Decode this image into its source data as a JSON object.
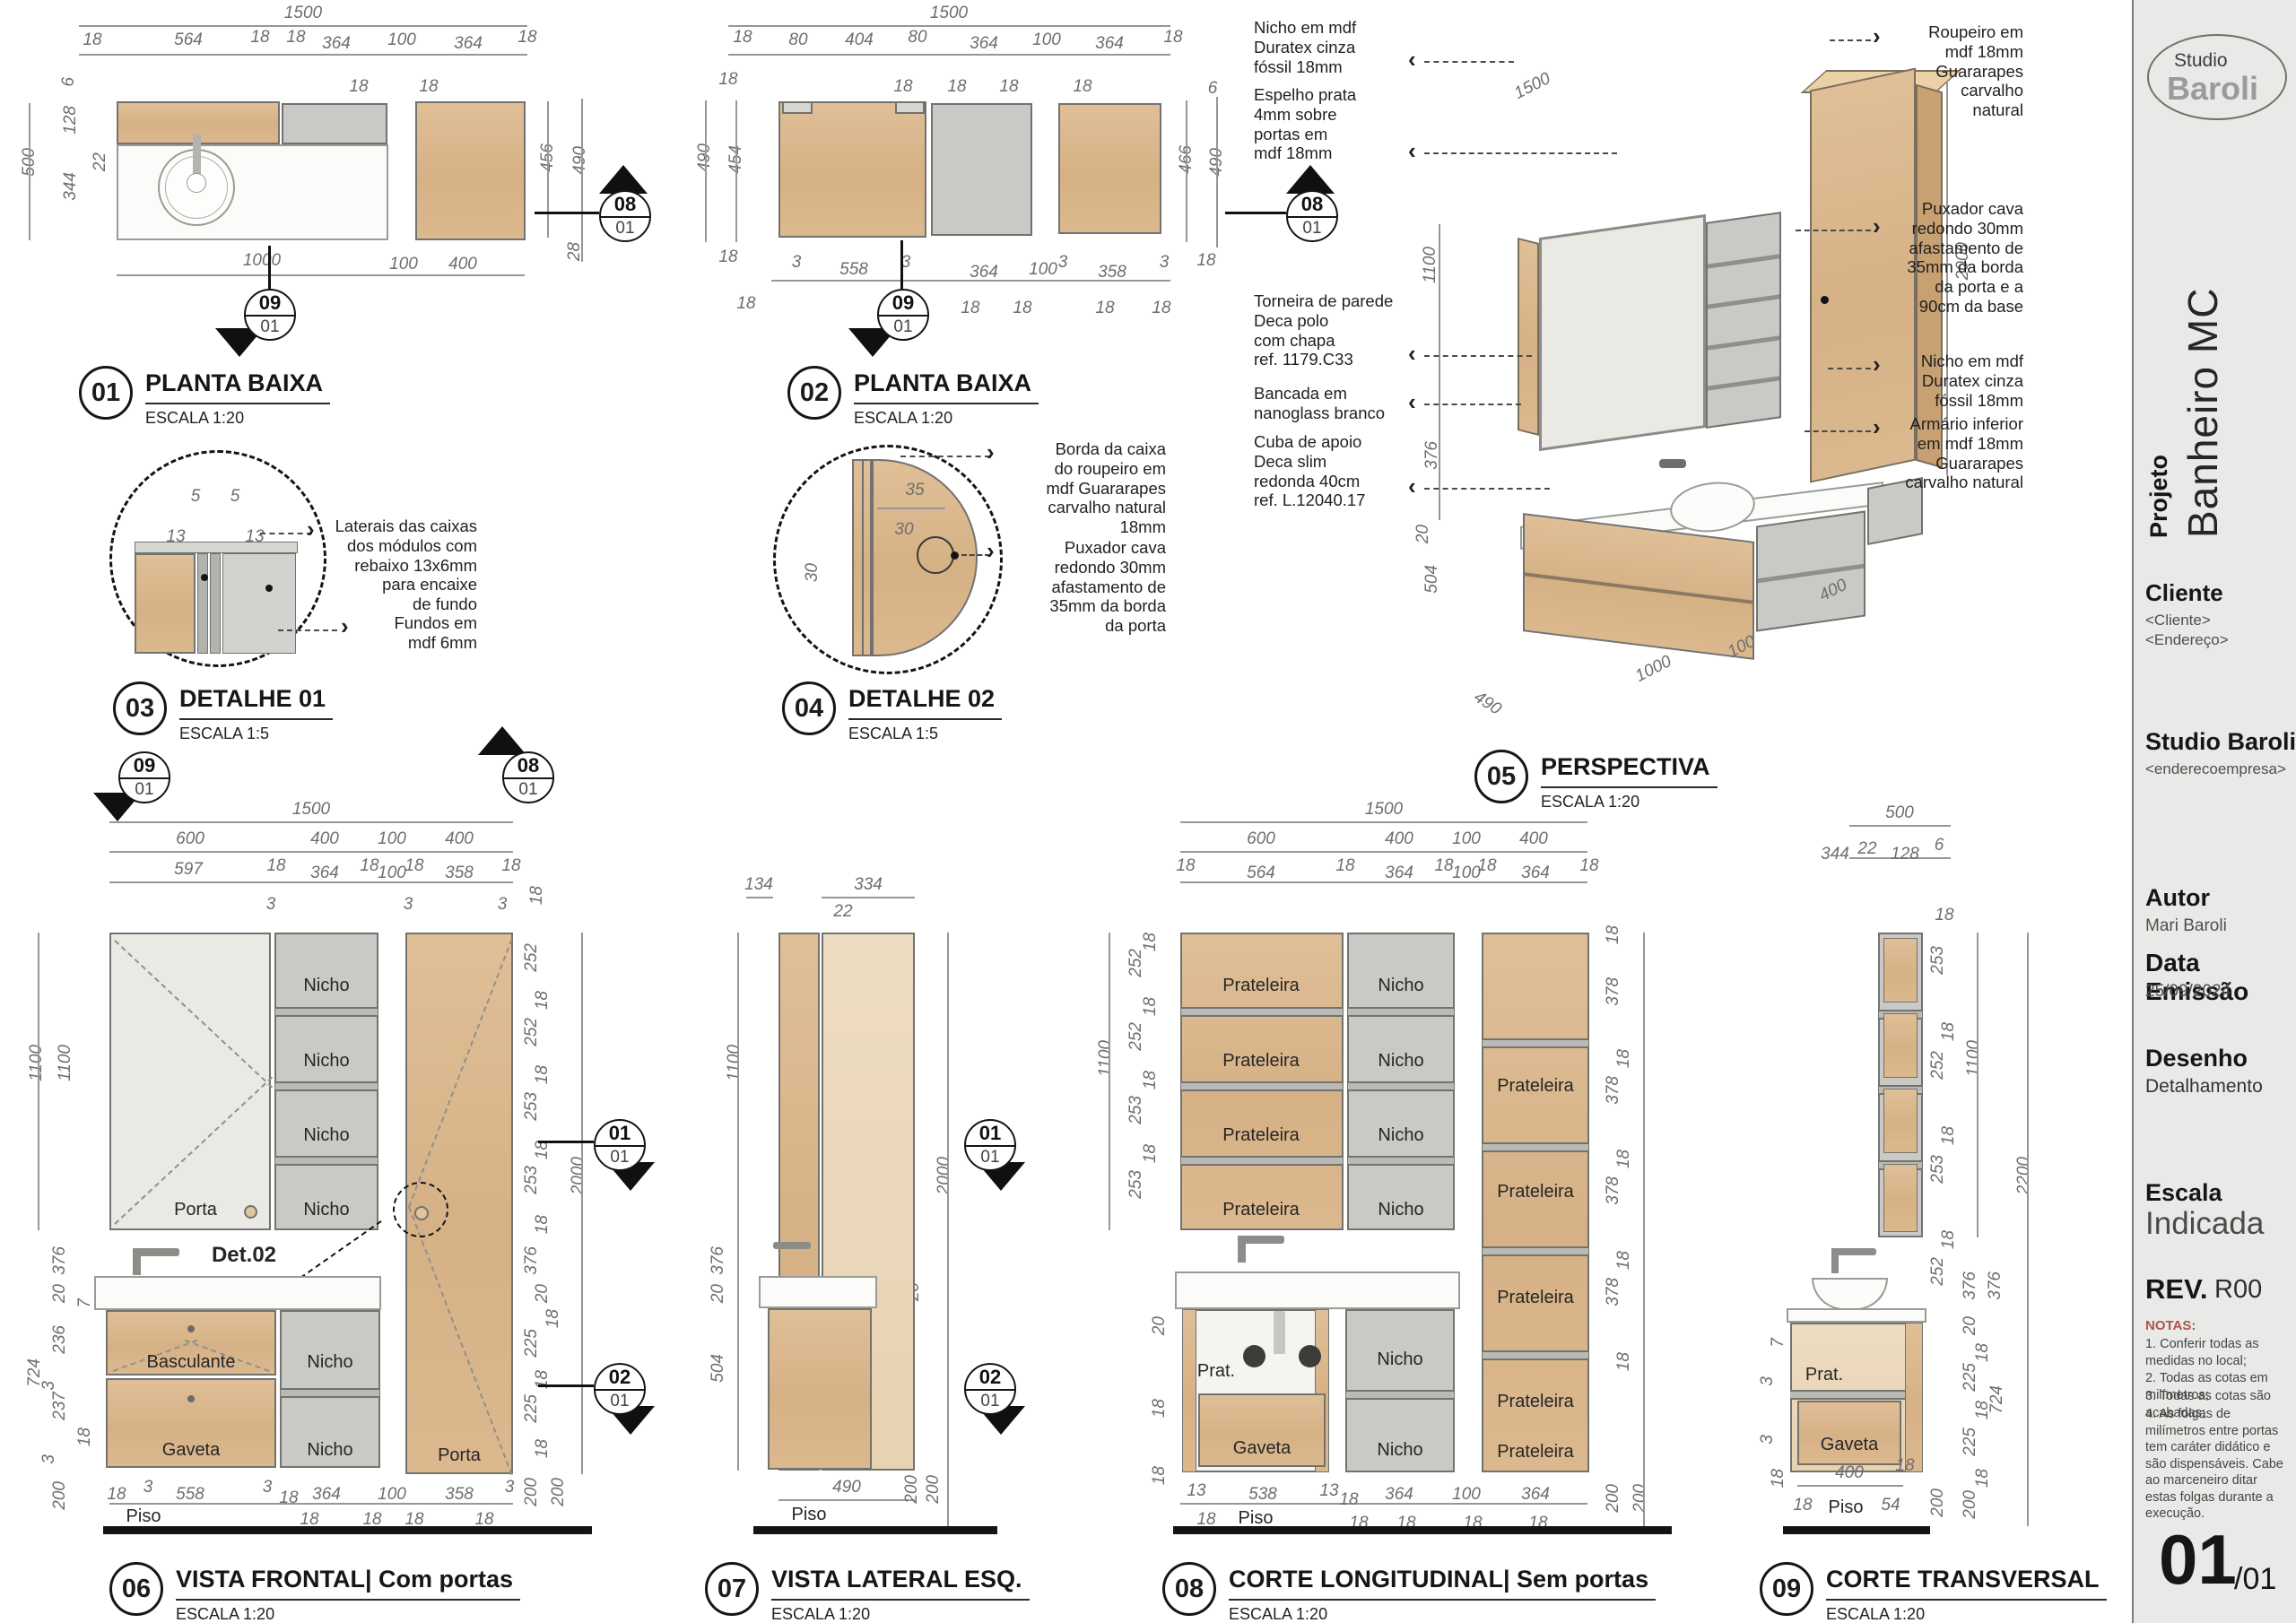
{
  "colors": {
    "wood": "#d8b68c",
    "wood_light": "#ead8bd",
    "panel_gray": "#c8c8c4",
    "mirror": "#ebe9e4",
    "ink": "#1c1c1c",
    "dim_gray": "#6e6e6e",
    "notes_red": "#b0534c",
    "titleblock_bg": "#e9e9e7"
  },
  "labels": {
    "nicho": "Nicho",
    "prateleira": "Prateleira",
    "porta": "Porta",
    "gaveta": "Gaveta",
    "basculante": "Basculante",
    "prat": "Prat.",
    "piso": "Piso",
    "det02": "Det.02"
  },
  "markers": {
    "m08": {
      "a": "08",
      "b": "01"
    },
    "m09": {
      "a": "09",
      "b": "01"
    },
    "m01": {
      "a": "01",
      "b": "01"
    },
    "m02": {
      "a": "02",
      "b": "01"
    }
  },
  "titleblock": {
    "logo_top": "Studio",
    "logo_main": "Baroli",
    "project_label": "Projeto",
    "project_name": "Banheiro MC",
    "cliente_label": "Cliente",
    "cliente_value": "<Cliente>",
    "cliente_endereco": "<Endereço>",
    "studio_name": "Studio Baroli",
    "studio_endereco": "<enderecoempresa>",
    "autor_label": "Autor",
    "autor_value": "Mari Baroli",
    "data_label": "Data Emissão",
    "data_value": "25/09/2024",
    "desenho_label": "Desenho",
    "desenho_value": "Detalhamento",
    "escala_label": "Escala",
    "escala_value": "Indicada",
    "rev_label": "REV.",
    "rev_value": "R00",
    "notas_title": "NOTAS:",
    "notas": [
      "1. Conferir todas as medidas no local;",
      "2. Todas as cotas em milímetros;",
      "3. Todas as cotas são acabadas;",
      "4. As folgas de milímetros entre portas tem caráter didático e são dispensáveis. Cabe ao marceneiro ditar estas folgas durante a execução."
    ],
    "page_num": "01",
    "page_total": "/01"
  },
  "views": {
    "v01": {
      "num": "01",
      "title": "PLANTA BAIXA",
      "scale": "ESCALA 1:20",
      "dims": [
        "1500",
        "18",
        "564",
        "18",
        "18",
        "364",
        "100",
        "364",
        "18",
        "18",
        "18",
        "6",
        "128",
        "22",
        "344",
        "500",
        "1000",
        "100",
        "400",
        "456",
        "490",
        "28"
      ]
    },
    "v02": {
      "num": "02",
      "title": "PLANTA BAIXA",
      "scale": "ESCALA 1:20",
      "dims": [
        "1500",
        "18",
        "80",
        "404",
        "80",
        "364",
        "100",
        "364",
        "18",
        "18",
        "18",
        "18",
        "18",
        "490",
        "454",
        "18",
        "18",
        "6",
        "466",
        "490",
        "18",
        "3",
        "558",
        "3",
        "364",
        "100",
        "3",
        "358",
        "3",
        "18",
        "18",
        "18",
        "18",
        "18",
        "18"
      ]
    },
    "v03": {
      "num": "03",
      "title": "DETALHE 01",
      "scale": "ESCALA 1:5",
      "dims": [
        "5",
        "5",
        "13",
        "13"
      ],
      "ann1": "Laterais das caixas\ndos módulos com\nrebaixo 13x6mm\npara encaixe\nde fundo",
      "ann2": "Fundos em\nmdf 6mm"
    },
    "v04": {
      "num": "04",
      "title": "DETALHE 02",
      "scale": "ESCALA 1:5",
      "dims": [
        "35",
        "30",
        "30"
      ],
      "ann1": "Borda da caixa\ndo roupeiro em\nmdf Guararapes\ncarvalho natural\n18mm",
      "ann2": "Puxador cava\nredondo 30mm\nafastamento de\n35mm da borda\nda porta"
    },
    "v05": {
      "num": "05",
      "title": "PERSPECTIVA",
      "scale": "ESCALA 1:20",
      "dims": [
        "1500",
        "1100",
        "376",
        "20",
        "504",
        "2000",
        "490",
        "1000",
        "100",
        "400"
      ],
      "left_anns": [
        "Nicho em mdf\nDuratex cinza\nfóssil 18mm",
        "Espelho prata\n4mm sobre\nportas em\nmdf 18mm",
        "Torneira de parede\nDeca polo\ncom chapa\nref. 1179.C33",
        "Bancada em\nnanoglass branco",
        "Cuba de apoio\nDeca slim\nredonda 40cm\nref. L.12040.17"
      ],
      "right_anns": [
        "Roupeiro em\nmdf 18mm\nGuararapes\ncarvalho\nnatural",
        "Puxador cava\nredondo 30mm\nafastamento de\n35mm da borda\nda porta e a\n90cm da base",
        "Nicho em mdf\nDuratex cinza\nfóssil 18mm",
        "Armário inferior\nem mdf 18mm\nGuararapes\ncarvalho natural"
      ]
    },
    "v06": {
      "num": "06",
      "title": "VISTA FRONTAL| Com portas",
      "scale": "ESCALA 1:20",
      "dims": [
        "1500",
        "600",
        "400",
        "100",
        "400",
        "597",
        "18",
        "364",
        "18",
        "100",
        "18",
        "358",
        "18",
        "3",
        "3",
        "3",
        "18",
        "1100",
        "1100",
        "376",
        "20",
        "7",
        "236",
        "3",
        "237",
        "18",
        "3",
        "200",
        "724",
        "252",
        "18",
        "252",
        "18",
        "253",
        "18",
        "253",
        "18",
        "2000",
        "376",
        "20",
        "18",
        "225",
        "18",
        "225",
        "18",
        "200",
        "200",
        "18",
        "3",
        "558",
        "3",
        "18",
        "364",
        "100",
        "358",
        "3",
        "18",
        "18",
        "18",
        "18"
      ]
    },
    "v07": {
      "num": "07",
      "title": "VISTA LATERAL ESQ.",
      "scale": "ESCALA 1:20",
      "dims": [
        "134",
        "22",
        "334",
        "1100",
        "2000",
        "376",
        "20",
        "504",
        "20",
        "490",
        "200",
        "200"
      ]
    },
    "v08": {
      "num": "08",
      "title": "CORTE LONGITUDINAL| Sem portas",
      "scale": "ESCALA 1:20",
      "dims": [
        "1500",
        "600",
        "400",
        "100",
        "400",
        "564",
        "18",
        "18",
        "364",
        "18",
        "100",
        "18",
        "364",
        "18",
        "18",
        "252",
        "18",
        "252",
        "18",
        "253",
        "18",
        "253",
        "1100",
        "20",
        "18",
        "18",
        "18",
        "378",
        "18",
        "378",
        "18",
        "378",
        "18",
        "378",
        "18",
        "200",
        "200",
        "13",
        "538",
        "13",
        "18",
        "364",
        "100",
        "364",
        "18",
        "18",
        "18",
        "18",
        "18"
      ]
    },
    "v09": {
      "num": "09",
      "title": "CORTE TRANSVERSAL",
      "scale": "ESCALA 1:20",
      "dims": [
        "500",
        "344",
        "22",
        "128",
        "6",
        "18",
        "253",
        "18",
        "252",
        "18",
        "253",
        "18",
        "252",
        "1100",
        "376",
        "376",
        "20",
        "18",
        "225",
        "18",
        "225",
        "18",
        "200",
        "724",
        "2200",
        "7",
        "3",
        "3",
        "18",
        "400",
        "18",
        "18",
        "54",
        "200"
      ]
    }
  }
}
